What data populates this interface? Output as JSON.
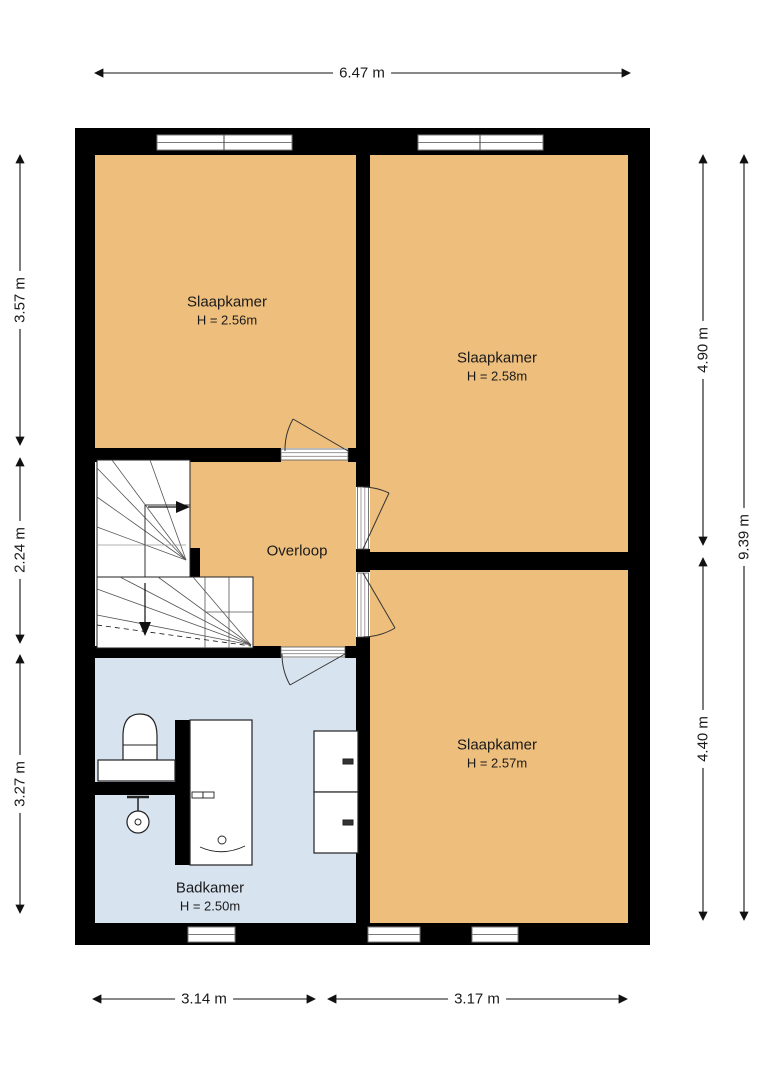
{
  "plan": {
    "title": "Verdieping plattegrond",
    "rooms": [
      {
        "id": "slaapkamer-1",
        "name": "Slaapkamer",
        "height": "H = 2.56m"
      },
      {
        "id": "slaapkamer-2",
        "name": "Slaapkamer",
        "height": "H = 2.58m"
      },
      {
        "id": "slaapkamer-3",
        "name": "Slaapkamer",
        "height": "H = 2.57m"
      },
      {
        "id": "overloop",
        "name": "Overloop",
        "height": ""
      },
      {
        "id": "badkamer",
        "name": "Badkamer",
        "height": "H = 2.50m"
      }
    ],
    "dimensions": {
      "top": "6.47 m",
      "left": [
        "3.57 m",
        "2.24 m",
        "3.27 m"
      ],
      "right": [
        "4.90 m",
        "4.40 m"
      ],
      "right_total": "9.39 m",
      "bottom": [
        "3.14 m",
        "3.17 m"
      ]
    },
    "colors": {
      "room_fill": "#EEBE7D",
      "bathroom_fill": "#D8E3F0",
      "wall": "#000000",
      "window_frame": "#7a7a7a",
      "dimension_text": "#1a1a1a"
    }
  }
}
